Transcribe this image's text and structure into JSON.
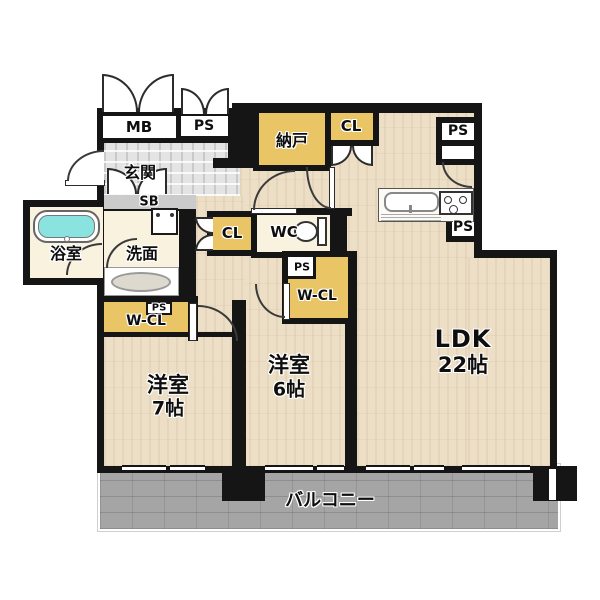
{
  "colors": {
    "wall": "#151515",
    "wood": "#EDDEC6",
    "cream": "#F8F2DF",
    "tile": "#E4E4E4",
    "closet": "#EAC566",
    "balcony": "#A5A5A5",
    "tub": "#8BE3E0",
    "sb_gray": "#CBCBCB"
  },
  "labels": {
    "mb": "MB",
    "ps": "PS",
    "genkan": "玄関",
    "sb": "SB",
    "bathroom": "浴室",
    "washroom": "洗面",
    "nando": "納戸",
    "cl": "CL",
    "wc": "WC",
    "wcl": "W-CL",
    "room7": {
      "name": "洋室",
      "size": "7帖"
    },
    "room6": {
      "name": "洋室",
      "size": "6帖"
    },
    "ldk": {
      "name": "LDK",
      "size": "22帖"
    },
    "balcony": "バルコニー"
  }
}
